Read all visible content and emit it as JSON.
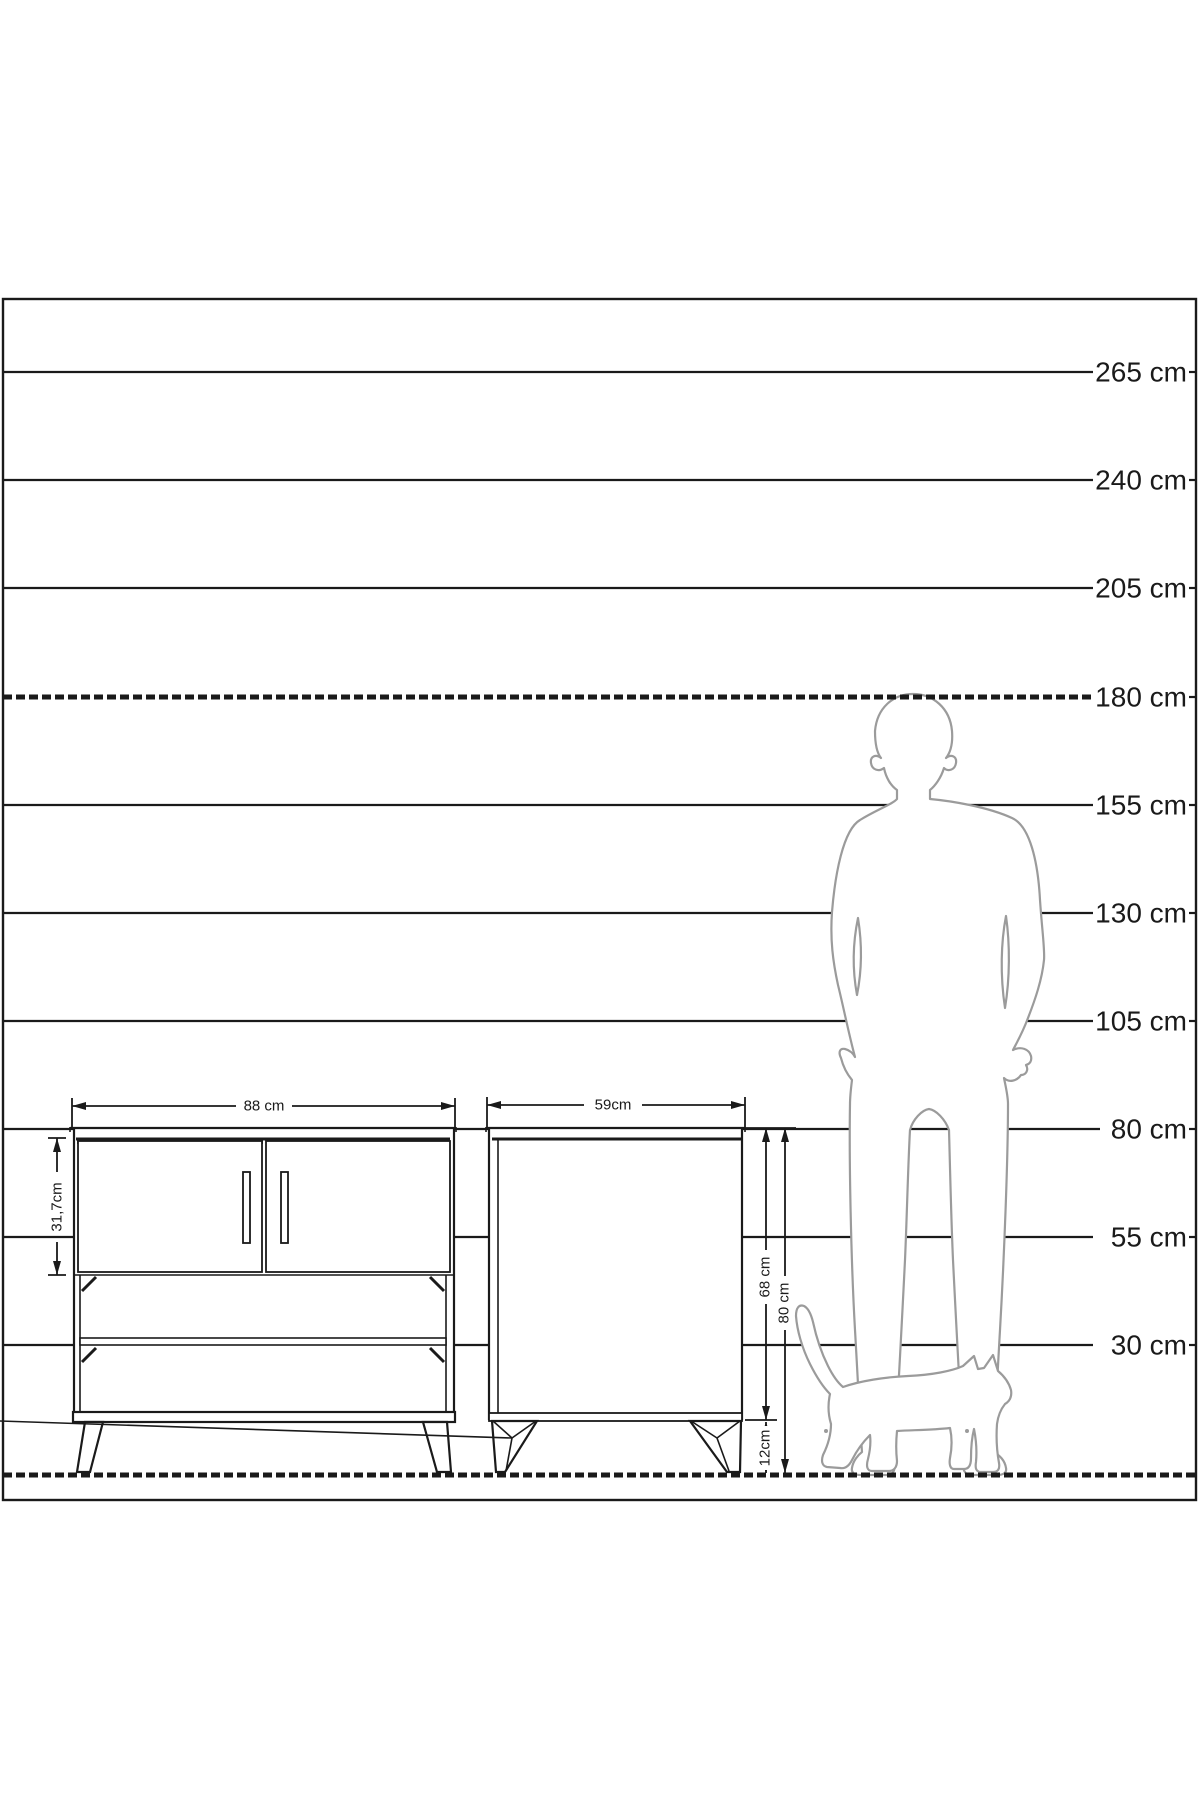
{
  "scale": {
    "labels": [
      "265 cm",
      "240 cm",
      "205 cm",
      "180 cm",
      "155 cm",
      "130 cm",
      "105 cm",
      "80 cm",
      "55 cm",
      "30 cm"
    ]
  },
  "dimensions": {
    "front_width": "88 cm",
    "door_height": "31,7cm",
    "side_depth": "59cm",
    "carcass_height": "68 cm",
    "total_height": "80 cm",
    "leg_height": "12cm"
  },
  "figures": {
    "person": "adult-man-outline",
    "cat": "walking-cat-outline"
  },
  "colors": {
    "line": "#1a1a1a",
    "silhouette": "#9b9b9b",
    "background": "#ffffff"
  }
}
